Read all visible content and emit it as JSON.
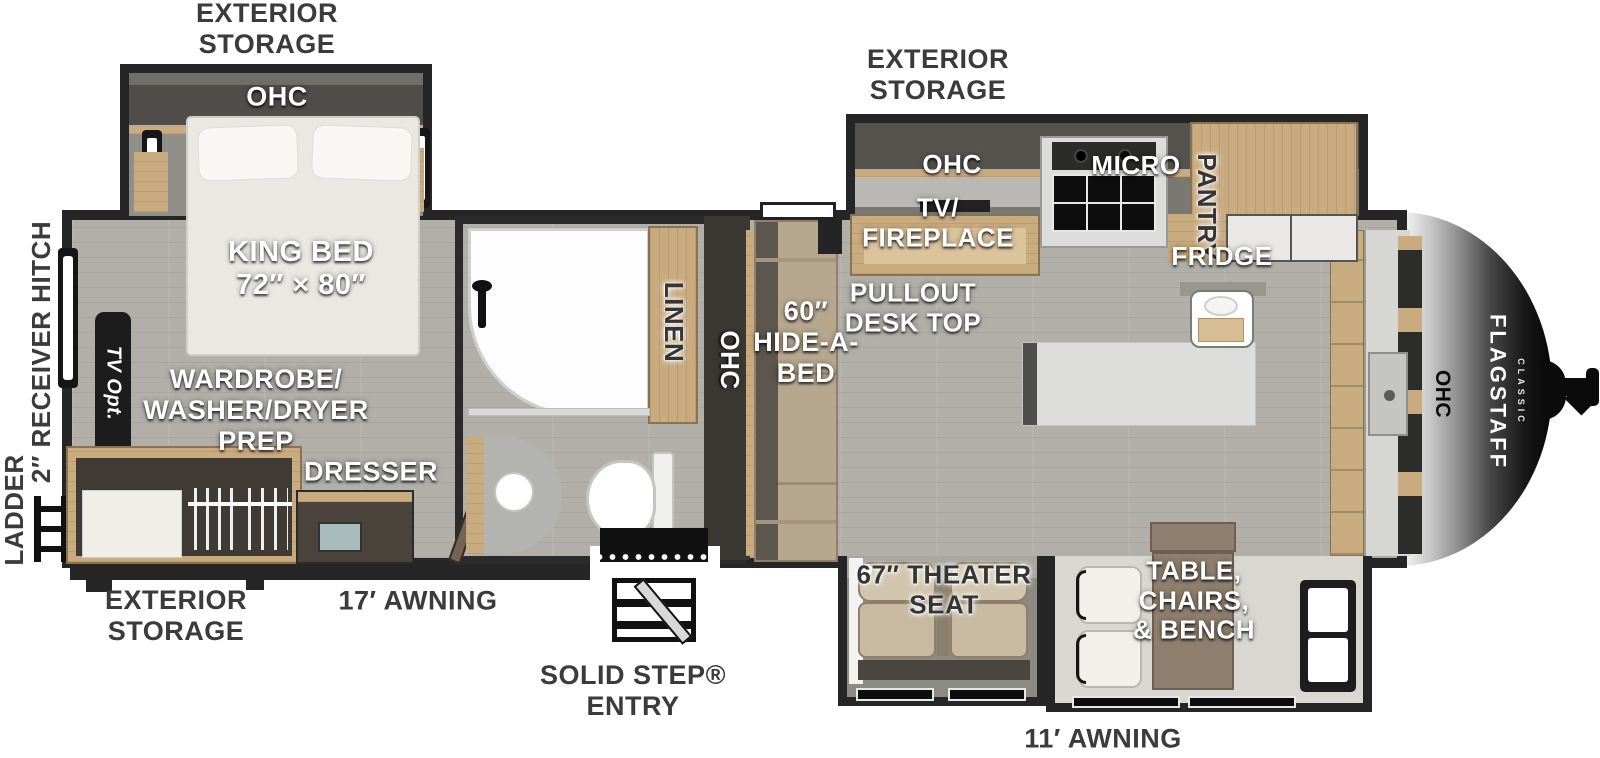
{
  "title": "Flagstaff Classic Travel Trailer Floorplan",
  "brand": {
    "name": "FLAGSTAFF",
    "series": "CLASSIC"
  },
  "colors": {
    "wall": "#262626",
    "floor": "#b1afa8",
    "slide_floor": "#d9d7d2",
    "wood": "#c9ab80",
    "wood_dark": "#8a7350",
    "sofa": "#b7a78f",
    "seat": "#c8b9a1",
    "island": "#dddddb",
    "label_dark": "#3b3b3b",
    "nose_dark": "#111111"
  },
  "labels": {
    "storage_rear": "EXTERIOR\nSTORAGE",
    "storage_kitchen": "EXTERIOR\nSTORAGE",
    "storage_bottom": "EXTERIOR\nSTORAGE",
    "bedroom_ohc": "OHC",
    "king_bed": "KING BED\n72″ × 80″",
    "receiver_hitch": "2″ RECEIVER HITCH",
    "ladder": "LADDER",
    "tv_opt": "TV Opt.",
    "wardrobe": "WARDROBE/\nWASHER/DRYER\nPREP",
    "dresser": "DRESSER",
    "linen": "LINEN",
    "hall_ohc": "OHC",
    "hide_a_bed": "60″\nHIDE-A-\nBED",
    "kitchen_ohc": "OHC",
    "tv_fireplace": "TV/\nFIREPLACE",
    "pullout_desk": "PULLOUT\nDESK TOP",
    "micro": "MICRO",
    "pantry": "PANTRY",
    "fridge": "FRIDGE",
    "awning_17": "17′ AWNING",
    "solid_step": "SOLID STEP®\nENTRY",
    "theater_seat": "67″ THEATER\nSEAT",
    "table_chairs": "TABLE,\nCHAIRS,\n& BENCH",
    "awning_11": "11′ AWNING",
    "front_ohc": "OHC"
  }
}
